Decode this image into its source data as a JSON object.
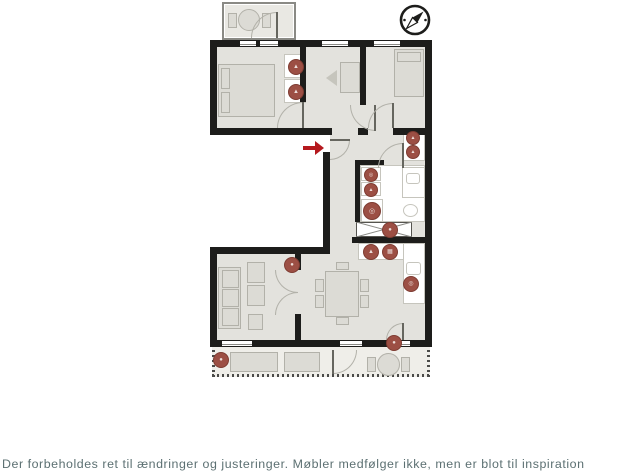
{
  "disclaimer": {
    "text": "Der forbeholdes ret til ændringer og justeringer. Møbler medfølger ikke, men er blot til inspiration"
  },
  "colors": {
    "wall": "#1d1d1b",
    "room_fill": "#e3e2dd",
    "furniture_fill": "#dcdbd5",
    "furniture_border": "#b2b1a9",
    "white_border": "#c6c5bd",
    "arcline": "#b2b1a9",
    "marker": "#9c4f44",
    "marker_border": "#7e3c32",
    "marker_glyph": "#ecdeda",
    "arrow": "#b5191e",
    "text": "#5c7072",
    "balcony_fill": "#efeee9",
    "balcony_top_fill": "#e9e8e3"
  },
  "icons": {
    "compass": "compass-rose-icon",
    "entrance_arrow": "entrance-arrow-icon"
  },
  "floorplan": {
    "marker_glyphs": {
      "wardrobe": "▲",
      "washer": "◎",
      "oven": "▦",
      "generic": "●"
    },
    "markers": [
      {
        "kind": "wardrobe",
        "x": 296,
        "y": 67,
        "r": 8
      },
      {
        "kind": "wardrobe",
        "x": 296,
        "y": 92,
        "r": 8
      },
      {
        "kind": "wardrobe",
        "x": 413,
        "y": 138,
        "r": 7
      },
      {
        "kind": "wardrobe",
        "x": 413,
        "y": 152,
        "r": 7
      },
      {
        "kind": "washer",
        "x": 371,
        "y": 175,
        "r": 7
      },
      {
        "kind": "wardrobe",
        "x": 371,
        "y": 190,
        "r": 7
      },
      {
        "kind": "washer",
        "x": 372,
        "y": 211,
        "r": 9
      },
      {
        "kind": "generic",
        "x": 390,
        "y": 230,
        "r": 8
      },
      {
        "kind": "wardrobe",
        "x": 371,
        "y": 252,
        "r": 8
      },
      {
        "kind": "oven",
        "x": 390,
        "y": 252,
        "r": 8
      },
      {
        "kind": "washer",
        "x": 411,
        "y": 284,
        "r": 8
      },
      {
        "kind": "generic",
        "x": 292,
        "y": 265,
        "r": 8
      },
      {
        "kind": "generic",
        "x": 394,
        "y": 343,
        "r": 8
      },
      {
        "kind": "generic",
        "x": 221,
        "y": 360,
        "r": 8
      }
    ]
  }
}
